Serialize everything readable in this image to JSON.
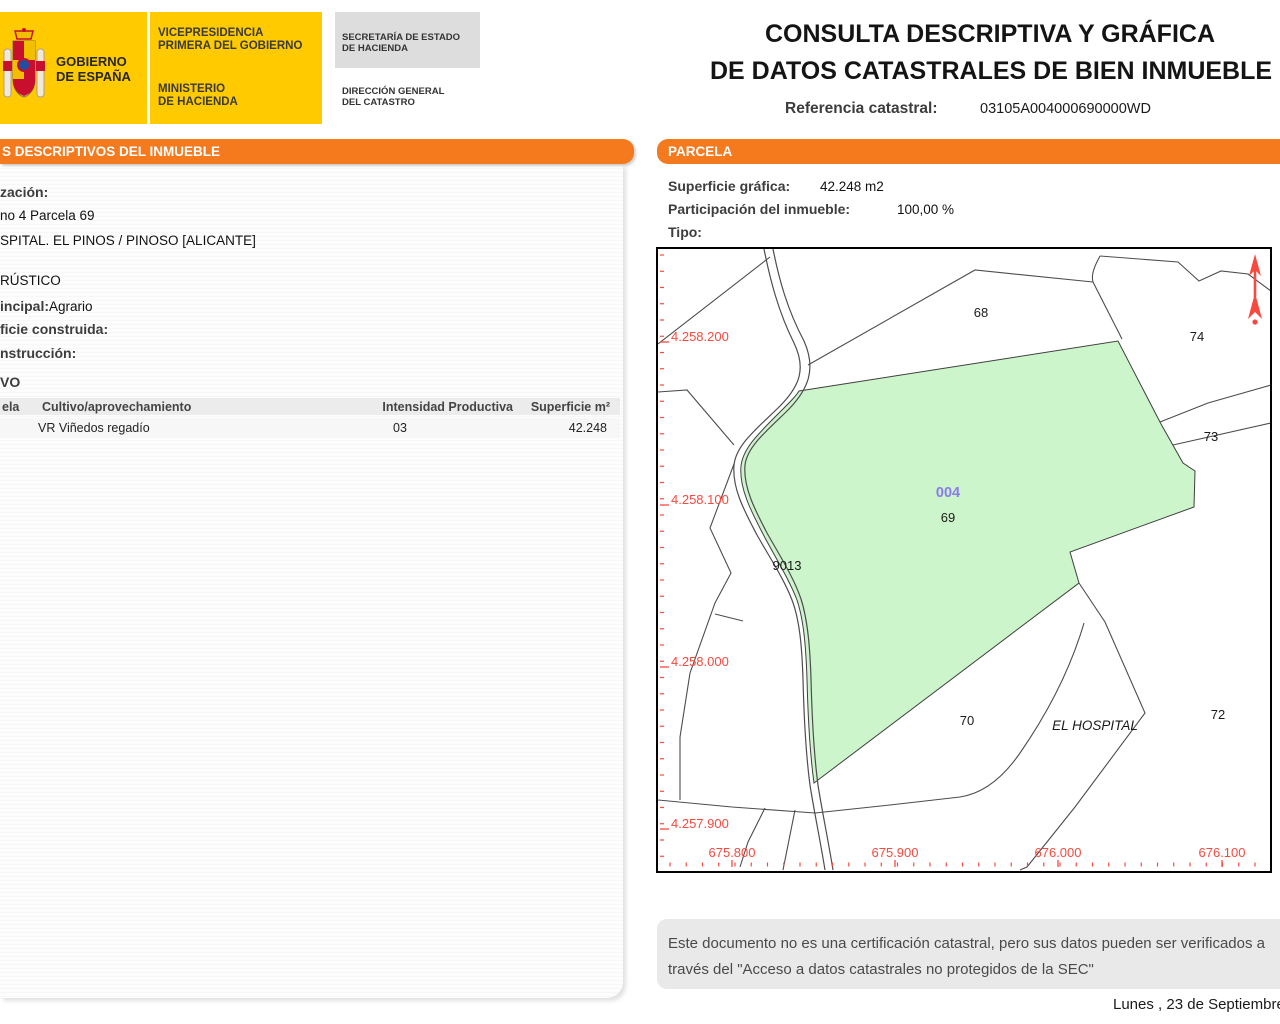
{
  "header": {
    "gobierno": [
      "GOBIERNO",
      "DE ESPAÑA"
    ],
    "vicepresidencia": [
      "VICEPRESIDENCIA",
      "PRIMERA DEL GOBIERNO"
    ],
    "ministerio": [
      "MINISTERIO",
      "DE HACIENDA"
    ],
    "secretaria": [
      "SECRETARÍA DE ESTADO",
      "DE HACIENDA"
    ],
    "direccion": [
      "DIRECCIÓN GENERAL",
      "DEL CATASTRO"
    ],
    "title_line1": "CONSULTA DESCRIPTIVA Y GRÁFICA",
    "title_line2": "DE DATOS CATASTRALES DE BIEN INMUEBLE",
    "referencia_label": "Referencia catastral:",
    "referencia_value": "03105A004000690000WD"
  },
  "left_panel": {
    "header": "S DESCRIPTIVOS DEL INMUEBLE",
    "localizacion_label": "zación:",
    "localizacion_line1": "no 4 Parcela 69",
    "localizacion_line2": "SPITAL. EL PINOS / PINOSO [ALICANTE]",
    "clase_value": "RÚSTICO",
    "uso_label": "incipal:",
    "uso_value": "Agrario",
    "superficie_label": "ficie construida:",
    "anio_label": "nstrucción:",
    "cultivo_heading": "VO",
    "table": {
      "col_subparcela": "ela",
      "col_cultivo": "Cultivo/aprovechamiento",
      "col_intensidad": "Intensidad Productiva",
      "col_superficie": "Superficie m²",
      "row_cultivo": "VR Viñedos regadío",
      "row_intensidad": "03",
      "row_superficie": "42.248"
    }
  },
  "right_panel": {
    "header": "PARCELA",
    "superficie_label": "Superficie gráfica:",
    "superficie_value": "42.248 m2",
    "participacion_label": "Participación del inmueble:",
    "participacion_value": "100,00 %",
    "tipo_label": "Tipo:",
    "disclaimer_line1": "Este documento no es una certificación catastral, pero sus datos pueden ser verificados a",
    "disclaimer_line2": "través del \"Acceso a datos catastrales no protegidos de la SEC\"",
    "date_text": "Lunes , 23 de Septiembre"
  },
  "map": {
    "colors": {
      "green_fill": "#cdf5cc",
      "parcel_stroke": "#3f3f3f",
      "line": "#4d4d4d",
      "red": "#f9493f",
      "purple": "#8b7bea",
      "label": "#1a1a1a"
    },
    "main_parcel": {
      "code": "004",
      "code_x": 290,
      "code_y": 248,
      "number": "69",
      "number_x": 290,
      "number_y": 273
    },
    "parcel_labels": [
      {
        "text": "68",
        "x": 323,
        "y": 68
      },
      {
        "text": "74",
        "x": 539,
        "y": 92
      },
      {
        "text": "73",
        "x": 553,
        "y": 192
      },
      {
        "text": "9013",
        "x": 129,
        "y": 321
      },
      {
        "text": "70",
        "x": 309,
        "y": 476
      },
      {
        "text": "72",
        "x": 560,
        "y": 470
      }
    ],
    "place_label": {
      "text": "EL HOSPITAL",
      "x": 437,
      "y": 481
    },
    "y_axis_labels": [
      {
        "text": "4.258.200",
        "y": 87
      },
      {
        "text": "4.258.100",
        "y": 250
      },
      {
        "text": "4.258.000",
        "y": 412
      },
      {
        "text": "4.257.900",
        "y": 574
      }
    ],
    "x_axis_labels": [
      {
        "text": "675.800",
        "x": 74
      },
      {
        "text": "675.900",
        "x": 237
      },
      {
        "text": "676.000",
        "x": 400
      },
      {
        "text": "676.100",
        "x": 564
      }
    ],
    "green_polygon": "M141,142 L460,92 L503,175 L525,214 L537,222 L536,258 L412,303 L421,334 L156,534 C152,505 150,470 149,430 C148,400 146,372 139,351 C131,330 117,308 105,285 C93,262 81,239 83,217 C85,199 101,184 123,162 C132,153 138,147 141,142 Z",
    "road_paths": [
      "M106,0 C112,30 120,62 136,94 C148,119 143,137 119,160 C96,182 78,197 76,216 C74,240 87,263 99,286 C112,309 126,330 134,351 C142,372 144,400 145,430 C146,470 148,506 152,536 C156,562 162,590 167,621",
      "M115,0 C121,30 129,60 146,92 C158,119 152,140 127,164 C105,185 89,199 87,216 C85,238 97,261 109,284 C122,307 136,329 143,350 C150,372 152,400 153,430 C154,470 156,506 160,536 C164,562 170,590 175,621"
    ],
    "boundary_paths": [
      "M0,95 L112,8",
      "M0,143 L29,141 L76,196",
      "M76,215 L52,279 L73,324 L57,354 L32,424 L22,488 L22,551",
      "M57,365 L85,372",
      "M0,551 L74,558 L157,564",
      "M107,559 L90,593 L82,618",
      "M137,561 L125,621",
      "M150,116 L317,21 L435,33",
      "M442,7 C436,18 433,26 435,33 L464,90",
      "M442,7 L520,13 L541,32 L563,22 L590,25 L613,42",
      "M502,173 L550,154 L613,136",
      "M515,196 L613,174",
      "M421,334 L447,373 L487,464 L417,558 L369,618 L362,621",
      "M426,374 C416,408 398,452 362,504 C342,533 322,545 302,548 L232,556 L157,564"
    ]
  }
}
